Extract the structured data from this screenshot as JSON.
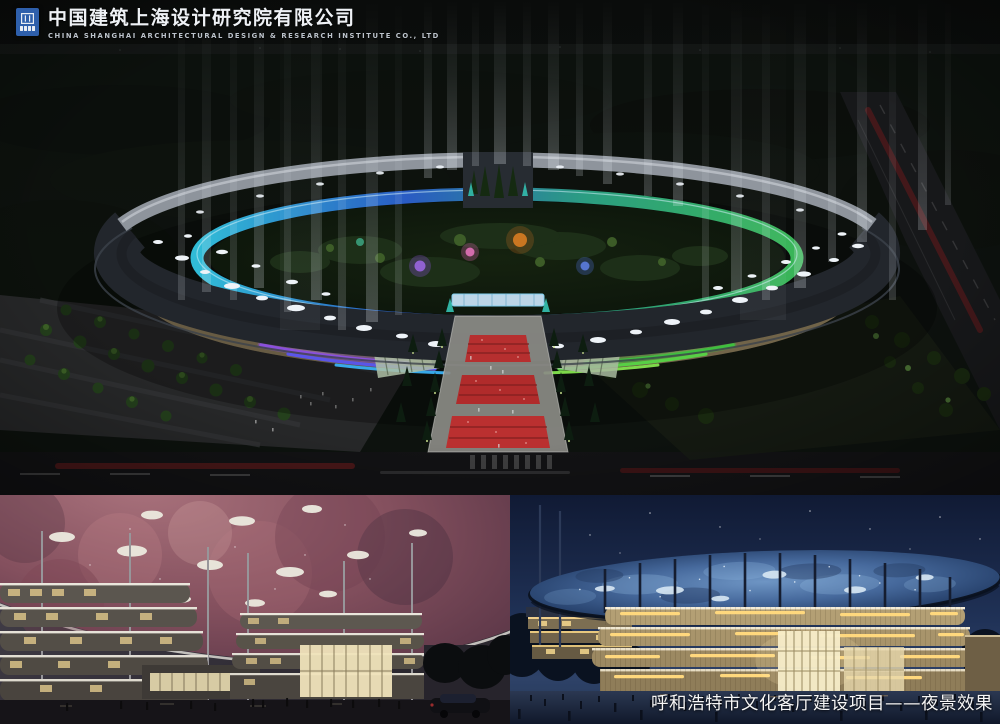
{
  "header": {
    "logo_icon": "cscec-logo-icon",
    "company_name_zh": "中国建筑上海设计研究院有限公司",
    "company_name_en": "CHINA SHANGHAI ARCHITECTURAL DESIGN & RESEARCH INSTITUTE CO., LTD"
  },
  "caption": {
    "text": "呼和浩特市文化客厅建设项目——夜景效果"
  },
  "colors": {
    "logo_blue": "#2e5fab",
    "night_sky": "#0a0c0b",
    "roof_dark": "#22262c",
    "rear_canopy_grey": "#8e949c",
    "glass_cyan": "#35d0ee",
    "glass_blue": "#2d64d8",
    "glass_teal": "#2fae8e",
    "led_red": "#e0344e",
    "led_magenta": "#dd4fa0",
    "led_purple": "#8a50dc",
    "led_violet": "#5b55e8",
    "led_cyan": "#37a8e8",
    "led_green": "#3fbf3f",
    "led_orange": "#ef8c22",
    "led_amber": "#f3b135",
    "facade_tan": "#8a7a5a",
    "walkway_red": "#b62f2f",
    "nebula_pink": "#8a4f5c",
    "canopy_skylight": "#eceadf",
    "disc_blue": "#46699c",
    "band_gold": "#a8946b",
    "strip_warm": "#ffd87d",
    "sky_navy_right": "#16203c",
    "sky_grey_left": "#3a363f"
  }
}
